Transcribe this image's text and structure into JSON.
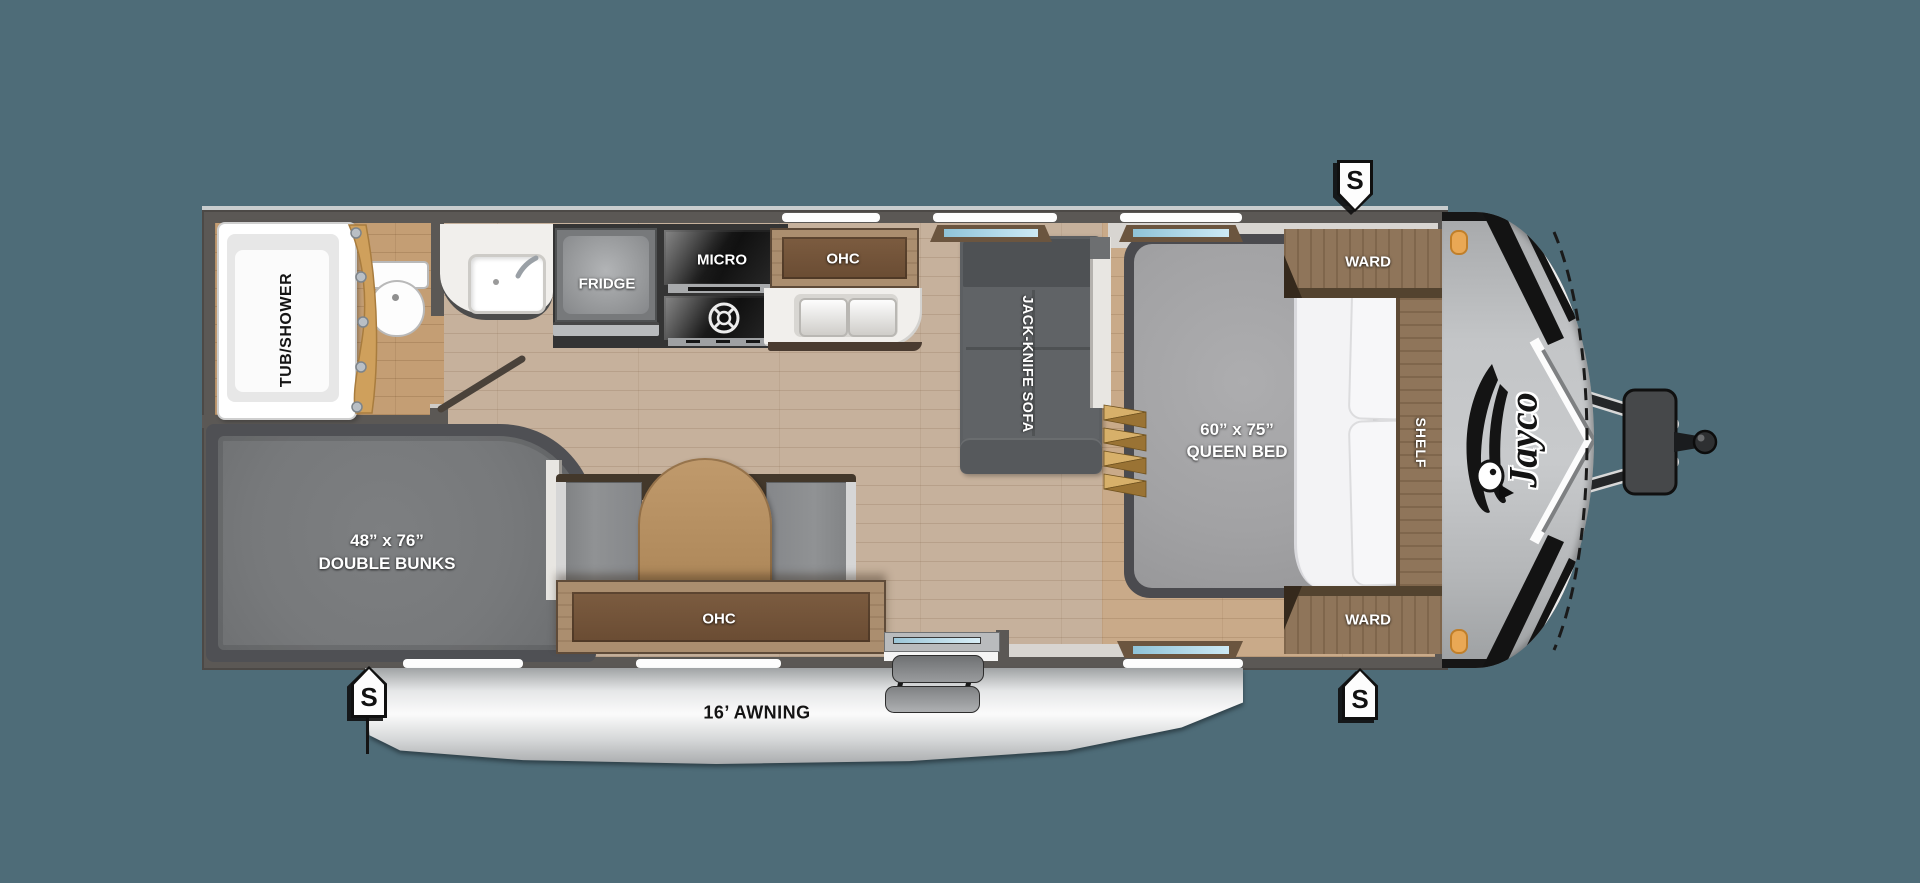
{
  "colors": {
    "background": "#4e6c78",
    "wall": "#5b5855",
    "floor_main": "#c6b19c",
    "floor_bathroom": "#c49e74",
    "floor_bedroom": "#c9aa89",
    "cabinet_wood": "#ab8e6f",
    "sofa_gray": "#5c5f62",
    "mattress_gray": "#a4a4a6",
    "bunk_gray": "#77797b",
    "counter_white": "#f1efec",
    "awning_gray": "#d3d5d6",
    "appliance_black": "#1c1c1c",
    "curtain_gold": "#cfa05c",
    "steps_gold": "#d7b06a",
    "marker_amber": "#e9a855",
    "window_blue": "#a8d4e4",
    "nose_cap_gray": "#bfc1c3"
  },
  "bathroom": {
    "tub_label": "TUB/SHOWER"
  },
  "kitchen": {
    "fridge_label": "FRIDGE",
    "micro_label": "MICRO",
    "ohc_label": "OHC"
  },
  "living": {
    "sofa_label": "JACK-KNIFE SOFA"
  },
  "dinette": {
    "ohc_label": "OHC"
  },
  "bedroom": {
    "ward_front_label": "WARD",
    "ward_rear_label": "WARD",
    "shelf_label": "SHELF",
    "bed_size": "60” x 75”",
    "bed_type": "QUEEN BED"
  },
  "bunk_room": {
    "bunk_size": "48” x 76”",
    "bunk_type": "DOUBLE BUNKS"
  },
  "exterior": {
    "awning_label": "16’ AWNING",
    "brand_logo": "Jayco",
    "marker_label": "S"
  }
}
